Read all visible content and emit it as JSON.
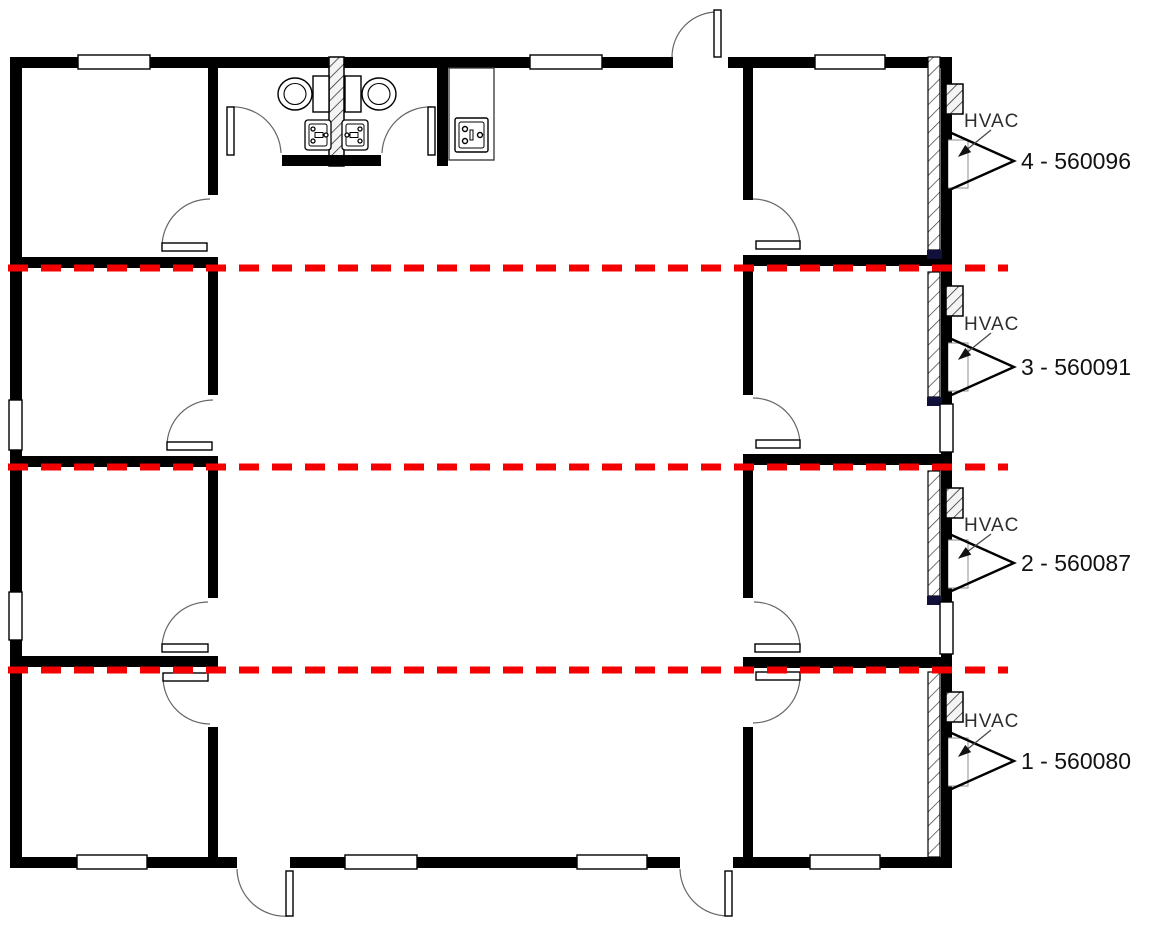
{
  "drawing": {
    "hvac_label": "HVAC",
    "modules": [
      {
        "label": "4 - 560096"
      },
      {
        "label": "3 - 560091"
      },
      {
        "label": "2 - 560087"
      },
      {
        "label": "1 - 560080"
      }
    ],
    "colors": {
      "wall": "#000000",
      "mate_line": "#f40000",
      "annotation": "#1a1a1a"
    }
  }
}
